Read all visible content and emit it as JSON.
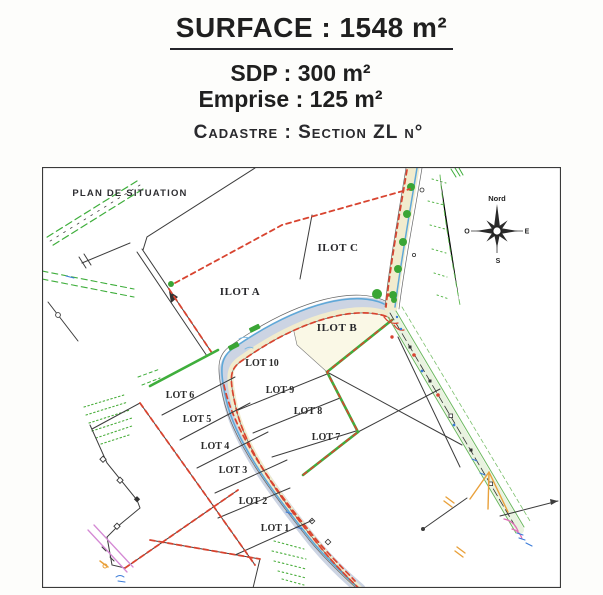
{
  "header": {
    "surface": "SURFACE : 1548 m²",
    "sdp": "SDP : 300 m²",
    "emprise": "Emprise : 125 m²",
    "cadastre": "Cadastre : Section ZL n°"
  },
  "map": {
    "plan_title": "PLAN DE SITUATION",
    "ilots": [
      "ILOT A",
      "ILOT B",
      "ILOT C"
    ],
    "lots": [
      "LOT 1",
      "LOT 2",
      "LOT 3",
      "LOT 4",
      "LOT 5",
      "LOT 6",
      "LOT 7",
      "LOT 8",
      "LOT 9",
      "LOT 10"
    ],
    "compass": {
      "north": "Nord",
      "east": "E",
      "south": "S",
      "west": "O"
    }
  },
  "colors": {
    "boundary_red": "#d84430",
    "parcel_green": "#3fae3c",
    "road_blue_grey": "#ccd4e3",
    "stream_blue": "#5fa8d8",
    "path_tan": "#f1ecce",
    "verge_green": "#e9f3e0",
    "utility_magenta": "#d489d4",
    "marker_orange": "#e9a13b",
    "ink": "#3c3c3c"
  }
}
